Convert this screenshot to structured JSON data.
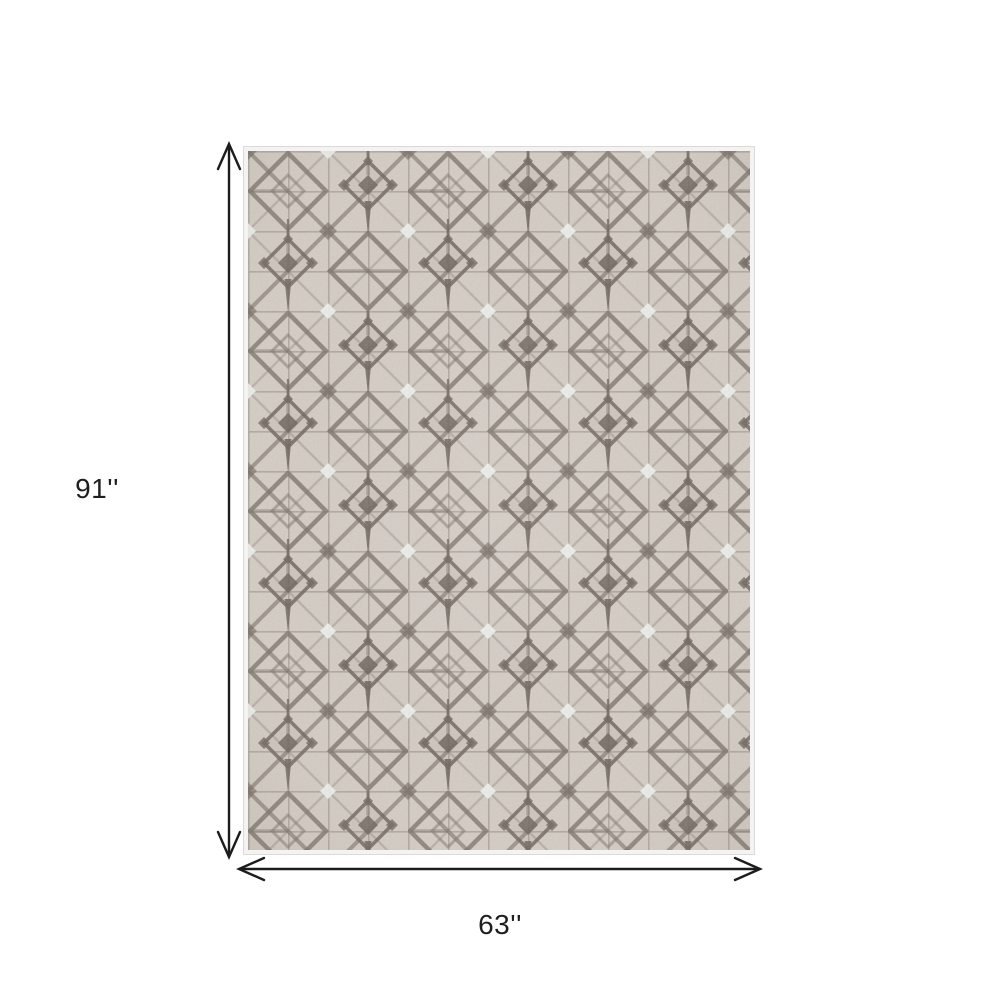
{
  "diagram": {
    "kind": "rug-dimension-diagram",
    "height_label": "91''",
    "width_label": "63''"
  },
  "rug": {
    "description": "beige and gray geometric diamond lattice area rug",
    "colors": {
      "base": "#d3ccc4",
      "binding": "#f4f3f1",
      "grid_line": "#8d8379",
      "lattice_mid": "#7b7167",
      "lattice_dark": "#6f665d",
      "highlight": "#eff0ee"
    }
  },
  "annotation": {
    "arrow_color": "#1c1c1c",
    "text_color": "#1f1f1f"
  }
}
